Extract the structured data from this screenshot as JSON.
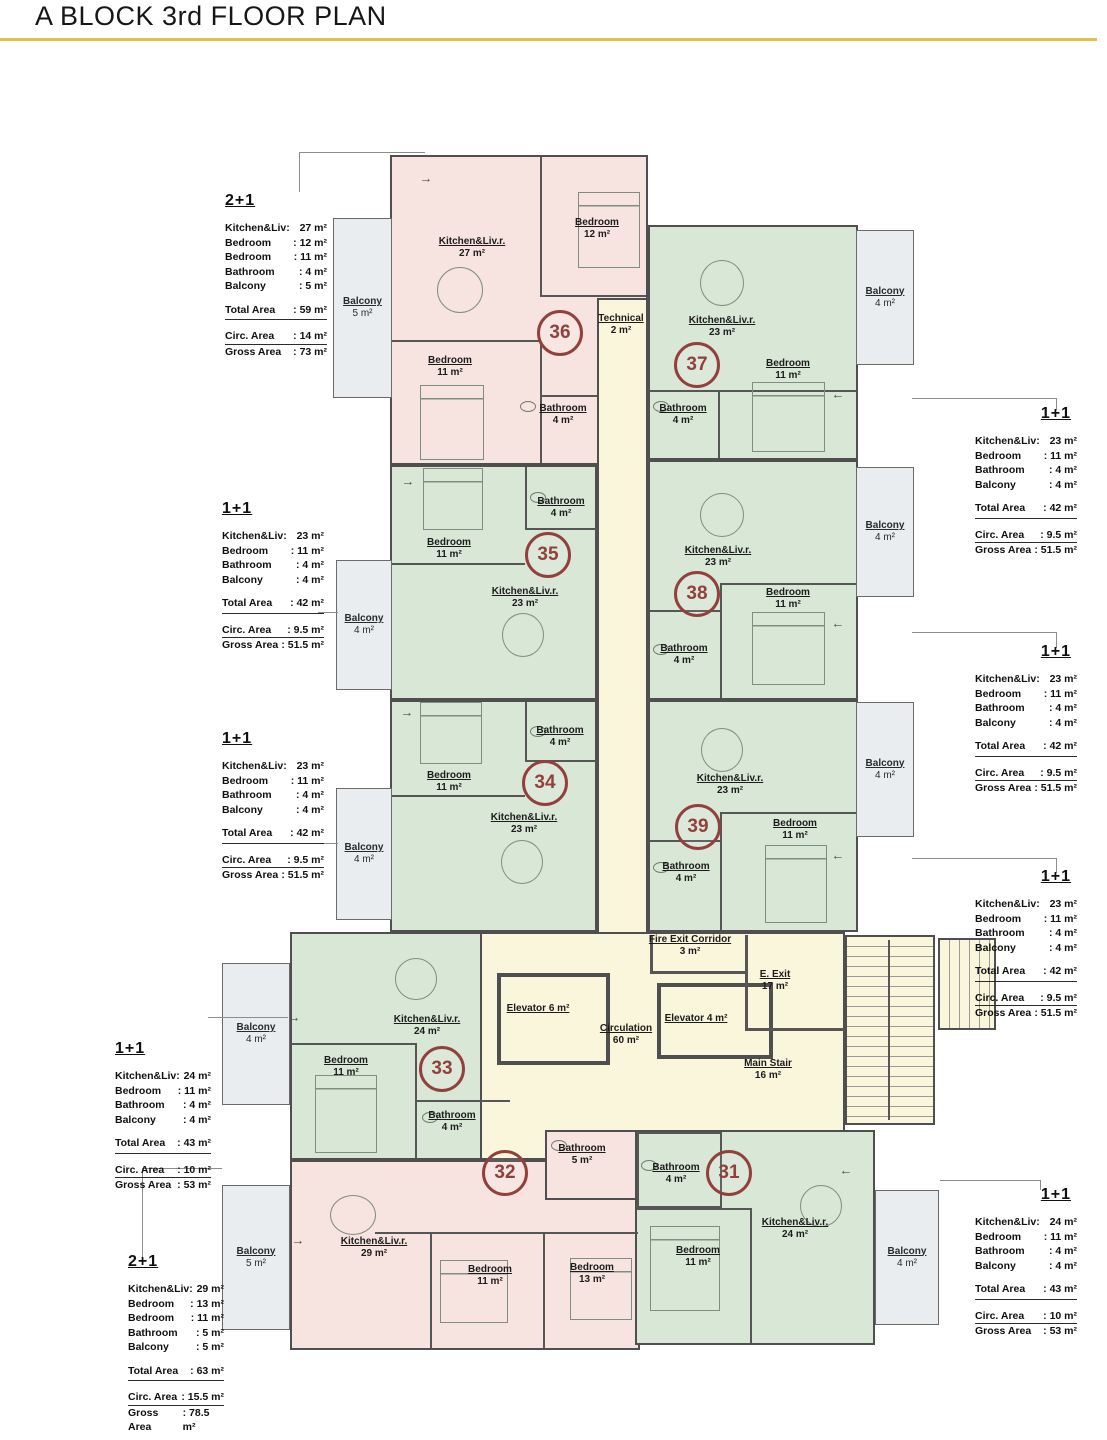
{
  "title": "A BLOCK 3rd FLOOR PLAN",
  "colors": {
    "accent_line": "#e4bf4b",
    "unit_2plus1_fill": "#f7e4e0",
    "unit_1plus1_fill": "#d9e7d7",
    "circulation_fill": "#faf6dc",
    "balcony_fill": "#e9edf0",
    "unit_number": "#93403c"
  },
  "icons": {
    "entry_arrow_right": "→",
    "entry_arrow_left": "←"
  },
  "units": [
    {
      "number": "31"
    },
    {
      "number": "32"
    },
    {
      "number": "33"
    },
    {
      "number": "34"
    },
    {
      "number": "35"
    },
    {
      "number": "36"
    },
    {
      "number": "37"
    },
    {
      "number": "38"
    },
    {
      "number": "39"
    }
  ],
  "rooms": [
    {
      "name": "Kitchen&Liv.r.",
      "area": "27 m²"
    },
    {
      "name": "Bedroom",
      "area": "12 m²"
    },
    {
      "name": "Bedroom",
      "area": "11 m²"
    },
    {
      "name": "Bathroom",
      "area": "4 m²"
    },
    {
      "name": "Technical",
      "area": "2 m²"
    },
    {
      "name": "Kitchen&Liv.r.",
      "area": "23 m²"
    },
    {
      "name": "Bedroom",
      "area": "11 m²"
    },
    {
      "name": "Bathroom",
      "area": "4 m²"
    },
    {
      "name": "Bedroom",
      "area": "11 m²"
    },
    {
      "name": "Bathroom",
      "area": "4 m²"
    },
    {
      "name": "Kitchen&Liv.r.",
      "area": "23 m²"
    },
    {
      "name": "Kitchen&Liv.r.",
      "area": "23 m²"
    },
    {
      "name": "Bedroom",
      "area": "11 m²"
    },
    {
      "name": "Bathroom",
      "area": "4 m²"
    },
    {
      "name": "Bedroom",
      "area": "11 m²"
    },
    {
      "name": "Bathroom",
      "area": "4 m²"
    },
    {
      "name": "Kitchen&Liv.r.",
      "area": "23 m²"
    },
    {
      "name": "Kitchen&Liv.r.",
      "area": "23 m²"
    },
    {
      "name": "Bedroom",
      "area": "11 m²"
    },
    {
      "name": "Bathroom",
      "area": "4 m²"
    },
    {
      "name": "Fire Exit Corridor",
      "area": "3 m²"
    },
    {
      "name": "E. Exit",
      "area": "17 m²"
    },
    {
      "name": "Elevator  6 m²",
      "area": ""
    },
    {
      "name": "Elevator  4 m²",
      "area": ""
    },
    {
      "name": "Circulation",
      "area": "60 m²"
    },
    {
      "name": "Main Stair",
      "area": "16 m²"
    },
    {
      "name": "Kitchen&Liv.r.",
      "area": "24 m²"
    },
    {
      "name": "Bedroom",
      "area": "11 m²"
    },
    {
      "name": "Bathroom",
      "area": "4 m²"
    },
    {
      "name": "Bathroom",
      "area": "5 m²"
    },
    {
      "name": "Kitchen&Liv.r.",
      "area": "29 m²"
    },
    {
      "name": "Bedroom",
      "area": "11 m²"
    },
    {
      "name": "Bedroom",
      "area": "13 m²"
    },
    {
      "name": "Bathroom",
      "area": "4 m²"
    },
    {
      "name": "Bedroom",
      "area": "11 m²"
    },
    {
      "name": "Kitchen&Liv.r.",
      "area": "24 m²"
    }
  ],
  "balconies": [
    {
      "label": "Balcony",
      "area": "5 m²"
    },
    {
      "label": "Balcony",
      "area": "4 m²"
    },
    {
      "label": "Balcony",
      "area": "4 m²"
    },
    {
      "label": "Balcony",
      "area": "4 m²"
    },
    {
      "label": "Balcony",
      "area": "4 m²"
    },
    {
      "label": "Balcony",
      "area": "4 m²"
    },
    {
      "label": "Balcony",
      "area": "4 m²"
    },
    {
      "label": "Balcony",
      "area": "5 m²"
    },
    {
      "label": "Balcony",
      "area": "4 m²"
    }
  ],
  "info_boxes": [
    {
      "type": "2+1",
      "rows": [
        {
          "l": "Kitchen&Liv:",
          "v": "27 m²"
        },
        {
          "l": "Bedroom",
          "v": ": 12 m²"
        },
        {
          "l": "Bedroom",
          "v": ": 11 m²"
        },
        {
          "l": "Bathroom",
          "v": ": 4 m²"
        },
        {
          "l": "Balcony",
          "v": ": 5 m²"
        }
      ],
      "total": {
        "l": "Total Area",
        "v": ": 59 m²"
      },
      "circ": {
        "l": "Circ. Area",
        "v": ": 14 m²"
      },
      "gross": {
        "l": "Gross Area",
        "v": ": 73 m²"
      }
    },
    {
      "type": "1+1",
      "rows": [
        {
          "l": "Kitchen&Liv:",
          "v": "23 m²"
        },
        {
          "l": "Bedroom",
          "v": ": 11 m²"
        },
        {
          "l": "Bathroom",
          "v": ": 4 m²"
        },
        {
          "l": "Balcony",
          "v": ": 4 m²"
        }
      ],
      "total": {
        "l": "Total Area",
        "v": ": 42 m²"
      },
      "circ": {
        "l": "Circ. Area",
        "v": ": 9.5 m²"
      },
      "gross": {
        "l": "Gross Area",
        "v": ": 51.5 m²"
      }
    },
    {
      "type": "1+1",
      "rows": [
        {
          "l": "Kitchen&Liv:",
          "v": "23 m²"
        },
        {
          "l": "Bedroom",
          "v": ": 11 m²"
        },
        {
          "l": "Bathroom",
          "v": ": 4 m²"
        },
        {
          "l": "Balcony",
          "v": ": 4 m²"
        }
      ],
      "total": {
        "l": "Total Area",
        "v": ": 42 m²"
      },
      "circ": {
        "l": "Circ. Area",
        "v": ": 9.5 m²"
      },
      "gross": {
        "l": "Gross Area",
        "v": ": 51.5 m²"
      }
    },
    {
      "type": "1+1",
      "rows": [
        {
          "l": "Kitchen&Liv:",
          "v": "24 m²"
        },
        {
          "l": "Bedroom",
          "v": ": 11 m²"
        },
        {
          "l": "Bathroom",
          "v": ": 4 m²"
        },
        {
          "l": "Balcony",
          "v": ": 4 m²"
        }
      ],
      "total": {
        "l": "Total Area",
        "v": ": 43 m²"
      },
      "circ": {
        "l": "Circ. Area",
        "v": ": 10 m²"
      },
      "gross": {
        "l": "Gross Area",
        "v": ": 53 m²"
      }
    },
    {
      "type": "2+1",
      "rows": [
        {
          "l": "Kitchen&Liv:",
          "v": "29 m²"
        },
        {
          "l": "Bedroom",
          "v": ": 13 m²"
        },
        {
          "l": "Bedroom",
          "v": ": 11 m²"
        },
        {
          "l": "Bathroom",
          "v": ": 5 m²"
        },
        {
          "l": "Balcony",
          "v": ": 5 m²"
        }
      ],
      "total": {
        "l": "Total Area",
        "v": ": 63 m²"
      },
      "circ": {
        "l": "Circ. Area",
        "v": ": 15.5 m²"
      },
      "gross": {
        "l": "Gross Area",
        "v": ": 78.5 m²"
      }
    },
    {
      "type": "1+1",
      "rows": [
        {
          "l": "Kitchen&Liv:",
          "v": "23 m²"
        },
        {
          "l": "Bedroom",
          "v": ": 11 m²"
        },
        {
          "l": "Bathroom",
          "v": ": 4 m²"
        },
        {
          "l": "Balcony",
          "v": ": 4 m²"
        }
      ],
      "total": {
        "l": "Total Area",
        "v": ": 42 m²"
      },
      "circ": {
        "l": "Circ. Area",
        "v": ": 9.5 m²"
      },
      "gross": {
        "l": "Gross Area",
        "v": ": 51.5 m²"
      }
    },
    {
      "type": "1+1",
      "rows": [
        {
          "l": "Kitchen&Liv:",
          "v": "23 m²"
        },
        {
          "l": "Bedroom",
          "v": ": 11 m²"
        },
        {
          "l": "Bathroom",
          "v": ": 4 m²"
        },
        {
          "l": "Balcony",
          "v": ": 4 m²"
        }
      ],
      "total": {
        "l": "Total Area",
        "v": ": 42 m²"
      },
      "circ": {
        "l": "Circ. Area",
        "v": ": 9.5 m²"
      },
      "gross": {
        "l": "Gross Area",
        "v": ": 51.5 m²"
      }
    },
    {
      "type": "1+1",
      "rows": [
        {
          "l": "Kitchen&Liv:",
          "v": "23 m²"
        },
        {
          "l": "Bedroom",
          "v": ": 11 m²"
        },
        {
          "l": "Bathroom",
          "v": ": 4 m²"
        },
        {
          "l": "Balcony",
          "v": ": 4 m²"
        }
      ],
      "total": {
        "l": "Total Area",
        "v": ": 42 m²"
      },
      "circ": {
        "l": "Circ. Area",
        "v": ": 9.5 m²"
      },
      "gross": {
        "l": "Gross Area",
        "v": ": 51.5 m²"
      }
    },
    {
      "type": "1+1",
      "rows": [
        {
          "l": "Kitchen&Liv:",
          "v": "24 m²"
        },
        {
          "l": "Bedroom",
          "v": ": 11 m²"
        },
        {
          "l": "Bathroom",
          "v": ": 4 m²"
        },
        {
          "l": "Balcony",
          "v": ": 4 m²"
        }
      ],
      "total": {
        "l": "Total Area",
        "v": ": 43 m²"
      },
      "circ": {
        "l": "Circ. Area",
        "v": ": 10 m²"
      },
      "gross": {
        "l": "Gross Area",
        "v": ": 53 m²"
      }
    }
  ]
}
